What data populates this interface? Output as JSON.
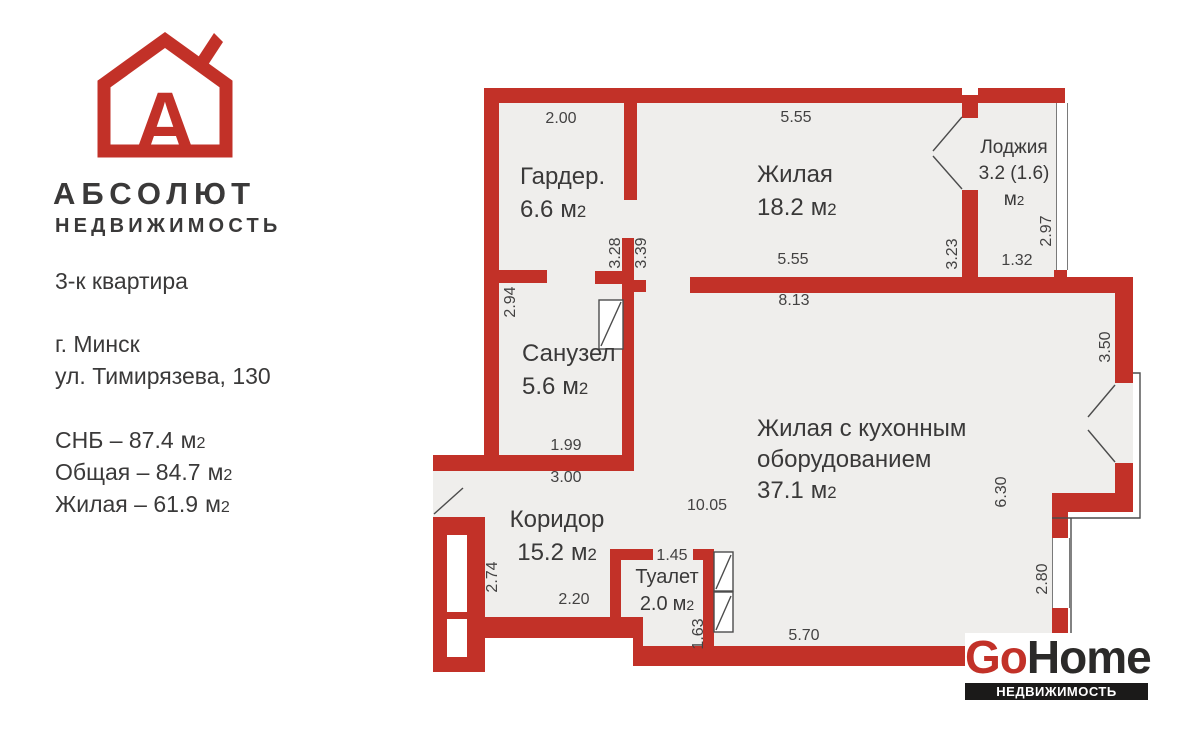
{
  "branding": {
    "logo_letter": "А",
    "company": "АБСОЛЮТ",
    "company_sub": "НЕДВИЖИМОСТЬ"
  },
  "listing": {
    "type": "3-к квартира",
    "city": "г. Минск",
    "address": "ул. Тимирязева, 130",
    "areas": [
      {
        "text": "СНБ – 87.4"
      },
      {
        "text": "Общая – 84.7"
      },
      {
        "text": "Жилая – 61.9"
      }
    ]
  },
  "unit": {
    "m": "м",
    "sub": "2"
  },
  "rooms": {
    "wardrobe": {
      "name": "Гардер.",
      "area": "6.6"
    },
    "living": {
      "name": "Жилая",
      "area": "18.2"
    },
    "loggia": {
      "name": "Лоджия",
      "area": "3.2 (1.6)"
    },
    "bathroom": {
      "name": "Санузел",
      "area": "5.6"
    },
    "kitchen": {
      "name_line1": "Жилая с кухонным",
      "name_line2": "оборудованием",
      "area": "37.1"
    },
    "corridor": {
      "name": "Коридор",
      "area": "15.2"
    },
    "toilet": {
      "name": "Туалет",
      "area": "2.0"
    }
  },
  "dims": {
    "d1": "2.00",
    "d2": "5.55",
    "d3": "2.97",
    "d4": "1.32",
    "d5": "3.23",
    "d6": "5.55",
    "d7": "8.13",
    "d8": "3.28",
    "d9": "3.39",
    "d10": "2.94",
    "d11": "1.99",
    "d12": "3.00",
    "d13": "10.05",
    "d14": "6.30",
    "d15": "3.50",
    "d16": "2.80",
    "d17": "2.74",
    "d18": "1.45",
    "d19": "1.63",
    "d20": "2.20",
    "d21": "5.70"
  },
  "footer": {
    "logo_red": "Go",
    "logo_dark": "Home",
    "tagline": "НЕДВИЖИМОСТЬ БЕЛАРУСИ"
  },
  "colors": {
    "wall": "#c23128",
    "floor": "#efeeec",
    "text": "#3a3939"
  }
}
